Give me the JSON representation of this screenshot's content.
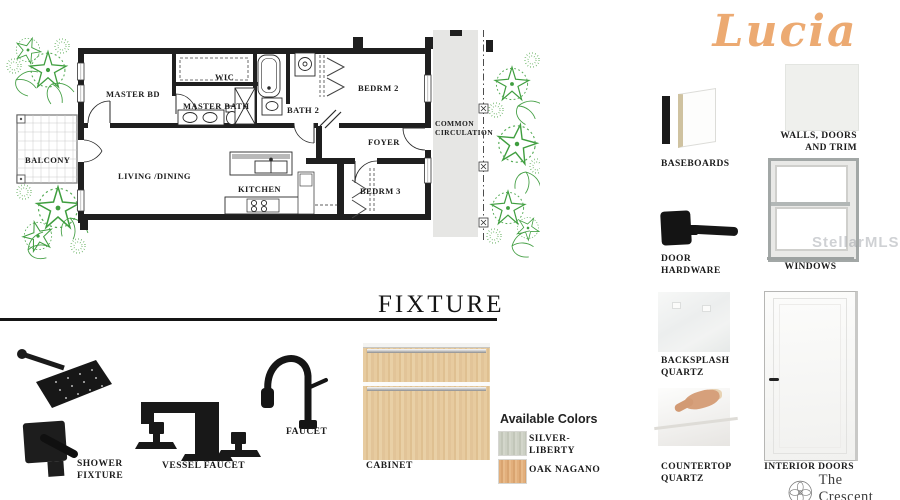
{
  "title": "Lucia",
  "accent_color": "#ecaa72",
  "floorplan": {
    "labels": {
      "master_bd": "MASTER BD",
      "wic": "WIC",
      "master_bath": "MASTER BATH",
      "bath_2": "BATH 2",
      "bedrm_2": "BEDRM 2",
      "common_1": "COMMON",
      "common_2": "CIRCULATION",
      "foyer": "FOYER",
      "balcony": "BALCONY",
      "living_dining": "LIVING /DINING",
      "kitchen": "KITCHEN",
      "bedrm_3": "BEDRM 3"
    }
  },
  "fixtures": {
    "heading": "FIXTURE",
    "shower_label_1": "SHOWER",
    "shower_label_2": "FIXTURE",
    "vessel_faucet_label": "VESSEL FAUCET",
    "faucet_label": "FAUCET",
    "cabinet_label": "CABINET",
    "colors_heading": "Available Colors",
    "colors": [
      {
        "line1": "SILVER-",
        "line2": "LIBERTY",
        "hex": "#c9cdc0"
      },
      {
        "line1": "OAK NAGANO",
        "line2": "",
        "hex": "#dfab79"
      }
    ]
  },
  "materials": {
    "baseboards": "BASEBOARDS",
    "walls_line1": "WALLS, DOORS",
    "walls_line2": "AND TRIM",
    "door_hw_1": "DOOR",
    "door_hw_2": "HARDWARE",
    "windows": "WINDOWS",
    "backsplash_1": "BACKSPLASH",
    "backsplash_2": "QUARTZ",
    "countertop_1": "COUNTERTOP",
    "countertop_2": "QUARTZ",
    "interior_doors": "INTERIOR DOORS"
  },
  "watermark": "StellarMLS",
  "brand": {
    "name": "The Crescent",
    "tagline": "at Reunion"
  }
}
